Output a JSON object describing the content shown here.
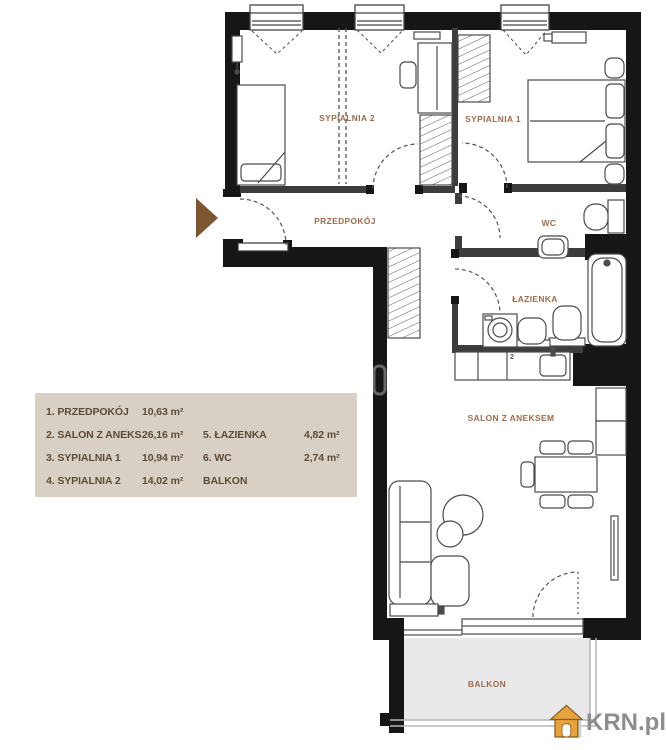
{
  "rooms": {
    "sypialnia2": {
      "label": "SYPIALNIA 2"
    },
    "sypialnia1": {
      "label": "SYPIALNIA 1"
    },
    "przedpokoj": {
      "label": "PRZEDPOKÓJ"
    },
    "wc": {
      "label": "WC"
    },
    "lazienka": {
      "label": "ŁAZIENKA"
    },
    "salon": {
      "label": "SALON Z ANEKSEM"
    },
    "balkon": {
      "label": "BALKON"
    },
    "salon_marker": "2"
  },
  "legend": {
    "column1": [
      {
        "name": "1. PRZEDPOKÓJ",
        "area": "10,63 m²"
      },
      {
        "name": "2. SALON Z ANEKS.",
        "area": "26,16 m²"
      },
      {
        "name": "3. SYPIALNIA 1",
        "area": "10,94 m²"
      },
      {
        "name": "4. SYPIALNIA 2",
        "area": "14,02 m²"
      }
    ],
    "column2": [
      {
        "name": "5. ŁAZIENKA",
        "area": "4,82 m²"
      },
      {
        "name": "6. WC",
        "area": "2,74 m²"
      },
      {
        "name": "BALKON",
        "area": ""
      }
    ]
  },
  "logo": {
    "text": "KRN.pl"
  },
  "colors": {
    "wall": "#161616",
    "inner_wall": "#3d3d3d",
    "room_label": "#9c6b4a",
    "legend_bg": "#d8d0c4",
    "legend_text": "#5d4b3a",
    "balcony_fill": "#e9e9ec",
    "entrance_arrow": "#7d5631",
    "logo_house": "#e8a33e",
    "logo_text": "#8d8d8d"
  }
}
